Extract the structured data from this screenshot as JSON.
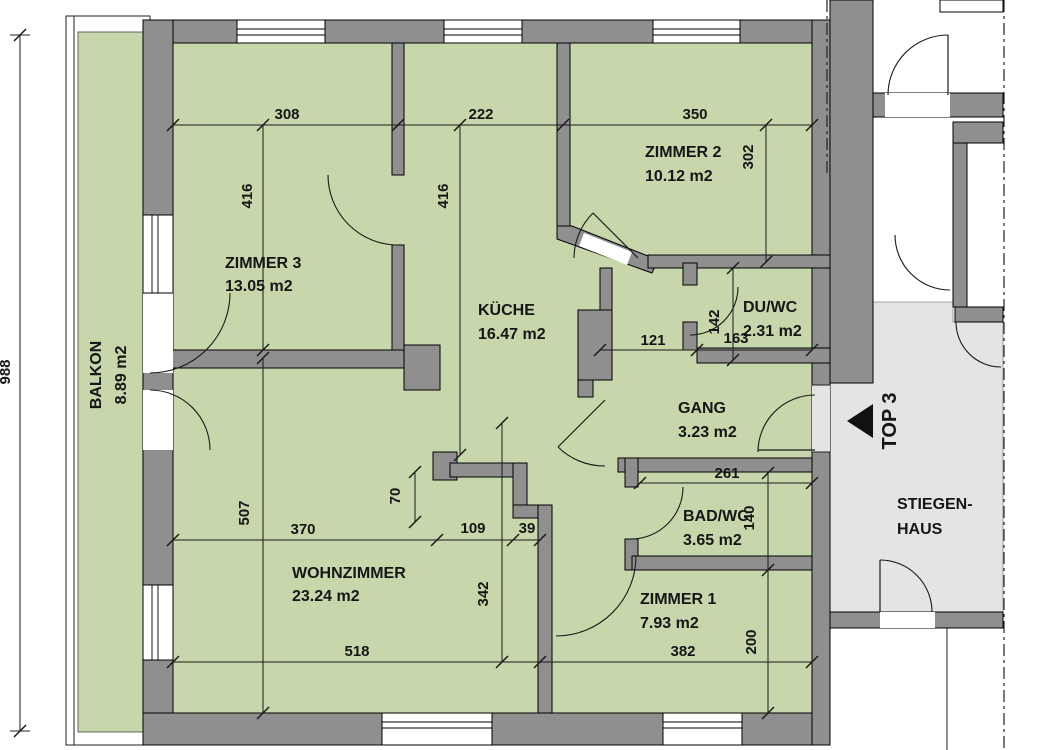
{
  "plan": {
    "rooms": {
      "balkon": {
        "name": "BALKON",
        "area": "8.89 m2"
      },
      "zimmer3": {
        "name": "ZIMMER 3",
        "area": "13.05 m2"
      },
      "kueche": {
        "name": "KÜCHE",
        "area": "16.47 m2"
      },
      "zimmer2": {
        "name": "ZIMMER 2",
        "area": "10.12 m2"
      },
      "duwc": {
        "name": "DU/WC",
        "area": "2.31 m2"
      },
      "gang": {
        "name": "GANG",
        "area": "3.23 m2"
      },
      "badwc": {
        "name": "BAD/WC",
        "area": "3.65 m2"
      },
      "wohnzimmer": {
        "name": "WOHNZIMMER",
        "area": "23.24 m2"
      },
      "zimmer1": {
        "name": "ZIMMER 1",
        "area": "7.93 m2"
      },
      "stiegenhaus": {
        "name_line1": "STIEGEN-",
        "name_line2": "HAUS"
      }
    },
    "unit_label": "TOP 3",
    "dimensions": {
      "d988": "988",
      "d308": "308",
      "d222": "222",
      "d350": "350",
      "d416_zimmer3": "416",
      "d416_kueche": "416",
      "d302": "302",
      "d142": "142",
      "d163": "163",
      "d121": "121",
      "d261": "261",
      "d140": "140",
      "d200": "200",
      "d507": "507",
      "d370": "370",
      "d109": "109",
      "d39": "39",
      "d70": "70",
      "d342": "342",
      "d518": "518",
      "d382": "382"
    },
    "colors": {
      "room_fill": "#c7d6ab",
      "wall_fill": "#8f8f8f",
      "stair_fill": "#e4e4e4"
    }
  }
}
